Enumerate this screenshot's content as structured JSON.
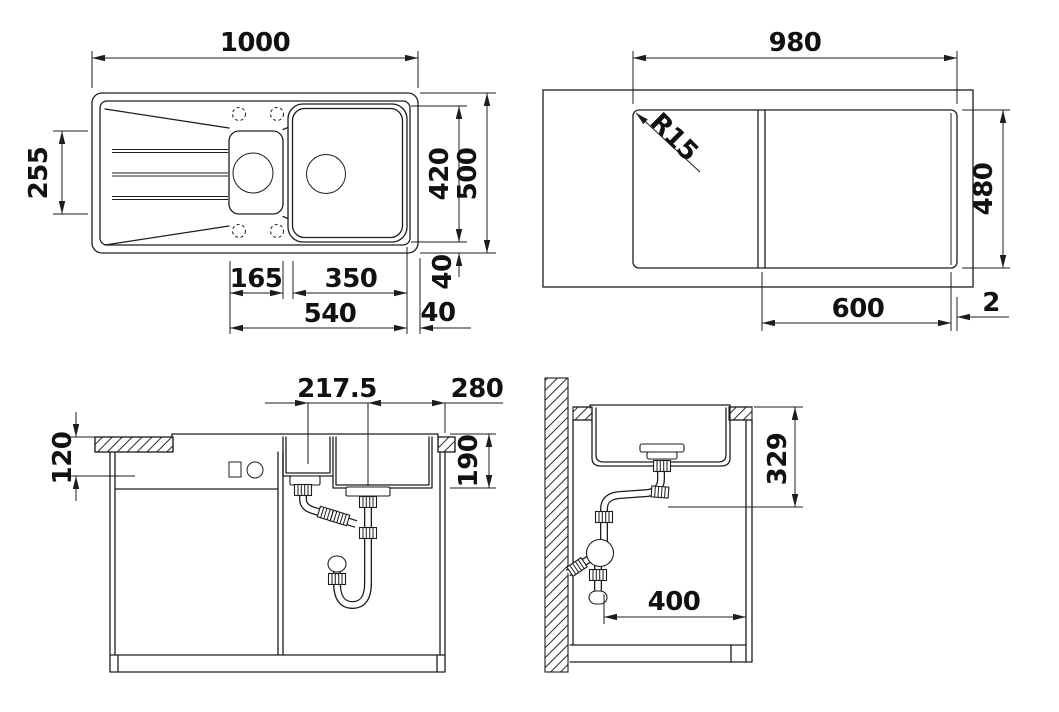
{
  "colors": {
    "ink": "#1d1d1d",
    "background": "#ffffff"
  },
  "views": {
    "sink_top_view": {
      "labels": {
        "overall_width": "1000",
        "left_section_height": "255",
        "bowl_height": "420",
        "overall_depth": "500",
        "bottom_rim": "40",
        "small_bowl_width": "165",
        "main_bowl_width": "350",
        "bowls_total_width": "540",
        "right_rim": "40"
      }
    },
    "cutout_top_view": {
      "labels": {
        "cutout_width": "980",
        "corner_radius": "R15",
        "cutout_depth": "480",
        "right_section_width": "600",
        "edge_gap": "2"
      }
    },
    "front_section_view": {
      "labels": {
        "drain_spacing": "217.5",
        "drain_to_right_edge": "280",
        "apron_height": "120",
        "bowl_depth": "190"
      }
    },
    "side_section_view": {
      "labels": {
        "drain_outlet_height": "329",
        "outlet_to_side": "400"
      }
    }
  }
}
